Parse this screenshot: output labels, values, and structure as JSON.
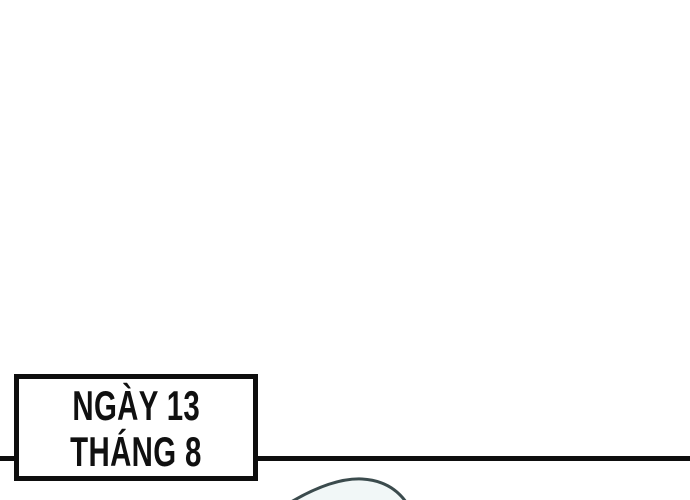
{
  "panel": {
    "date_box": {
      "line1": "NGÀY 13",
      "line2": "THÁNG 8"
    },
    "colors": {
      "background": "#ffffff",
      "ink": "#0e0e0e",
      "text": "#101010",
      "arc_stroke": "#3b4b4d",
      "arc_fill": "#f1f7f7"
    },
    "artwork": {
      "head_arc_fill_path": "M 291 502 C 315 488 340 478 362 479 C 381 480 396 488 406 502 Z",
      "head_arc_stroke_path": "M 291 502 C 315 488 340 478 362 479 C 381 480 396 488 406 502",
      "arc_stroke_width": "3"
    }
  }
}
